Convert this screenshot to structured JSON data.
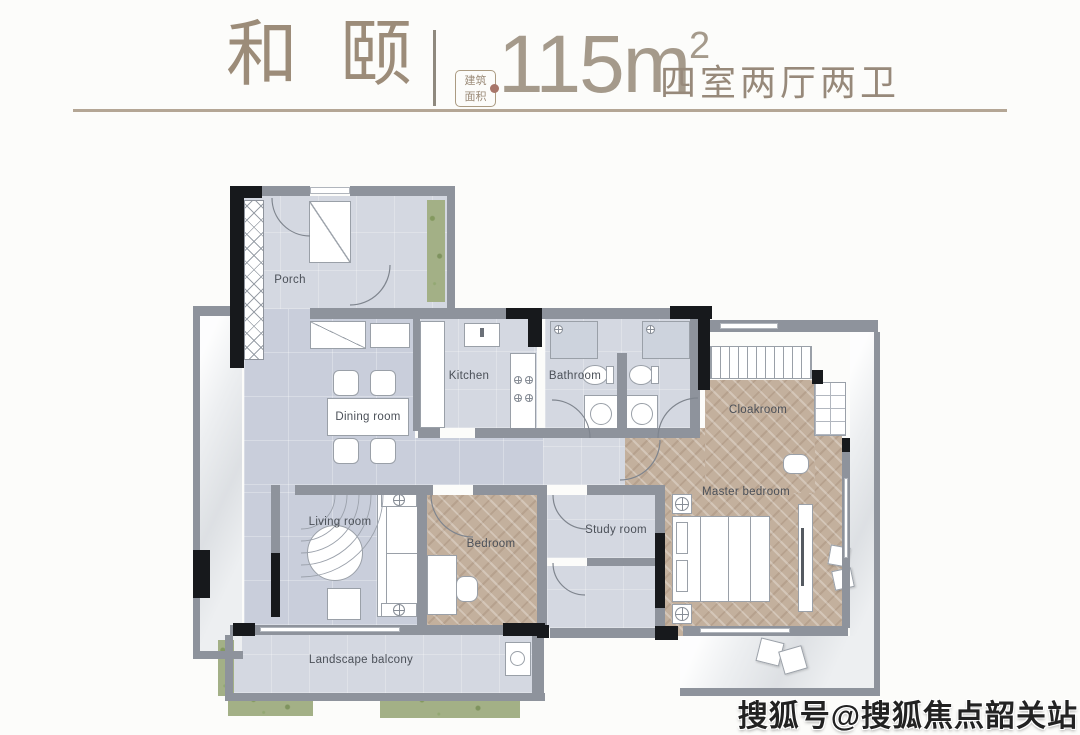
{
  "header": {
    "title": "和颐",
    "area_badge": {
      "line1": "建筑",
      "line2": "面积"
    },
    "area": {
      "value": "115",
      "unit": "m",
      "sup": "2"
    },
    "layout_text": "四室两厅两卫"
  },
  "floorplan": {
    "rooms": [
      {
        "id": "porch",
        "label": "Porch"
      },
      {
        "id": "kitchen",
        "label": "Kitchen"
      },
      {
        "id": "bathroom",
        "label": "Bathroom"
      },
      {
        "id": "dining-room",
        "label": "Dining room"
      },
      {
        "id": "cloakroom",
        "label": "Cloakroom"
      },
      {
        "id": "master-bedroom",
        "label": "Master bedroom"
      },
      {
        "id": "living-room",
        "label": "Living room"
      },
      {
        "id": "bedroom",
        "label": "Bedroom"
      },
      {
        "id": "study-room",
        "label": "Study room"
      },
      {
        "id": "landscape-balcony",
        "label": "Landscape balcony"
      }
    ]
  },
  "watermark": {
    "text": "搜狐号@搜狐焦点韶关站"
  },
  "colors": {
    "accent": "#9c8c79",
    "wall": "#8e939c",
    "floor_tile": "#c9cedb",
    "wood_floor": "#c3b09d",
    "plant": "#a3b086",
    "marble": "#edeff1"
  }
}
